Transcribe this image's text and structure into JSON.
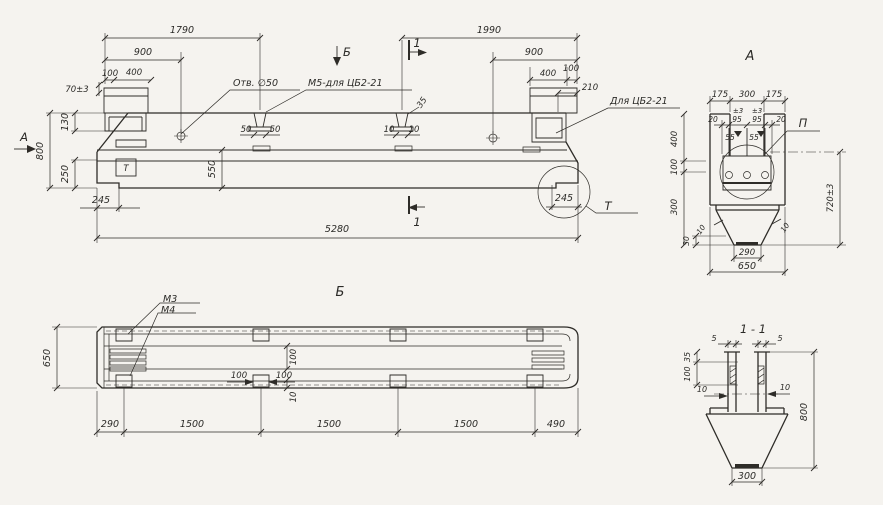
{
  "page": {
    "background": "#f5f3ef",
    "ink": "#2e2c28"
  },
  "main_view": {
    "view_arrow_left": "А",
    "view_arrow_top": "Б",
    "cut_mark_top": "1",
    "cut_mark_bottom": "1",
    "mark_box": "Т",
    "detail_callout": "Т",
    "label_hole": "Отв. ∅50",
    "label_anchor": "М5-для ЦБ2-21",
    "label_right": "Для ЦБ2-21",
    "dims": {
      "len_top_left": "1790",
      "len_top_right": "1990",
      "off_left": "900",
      "off_right": "900",
      "pad_100_left": "100",
      "pad_400_left": "400",
      "pad_400_right": "400",
      "pad_100_right": "100",
      "pad_210": "210",
      "tol_70": "70±3",
      "h_130": "130",
      "h_800": "800",
      "h_250": "250",
      "h_550": "550",
      "len_total": "5280",
      "notch_left": "245",
      "notch_right": "245",
      "stud1_l": "50",
      "stud1_r": "50",
      "stud2_l": "10",
      "stud2_r": "10",
      "stud2_d": "35"
    }
  },
  "view_b": {
    "title": "Б",
    "label_m3": "М3",
    "label_m4": "М4",
    "dims": {
      "width": "650",
      "c290": "290",
      "c1500a": "1500",
      "c1500b": "1500",
      "c1500c": "1500",
      "c490": "490",
      "mid_l": "100",
      "mid_r": "100",
      "mid_v": "100",
      "mid_10": "10"
    }
  },
  "section_a": {
    "title": "А",
    "detail_callout": "П",
    "dims": {
      "t175l": "175",
      "t300": "300",
      "t175r": "175",
      "b20l": "20",
      "b95l": "95",
      "b95r": "95",
      "b20r": "20",
      "tol_l": "±3",
      "tol_r": "±3",
      "w55l": "55",
      "w55r": "55",
      "h400": "400",
      "h100": "100",
      "h300": "300",
      "h30": "30",
      "f10l": "10",
      "f10r": "10",
      "h720": "720±3",
      "b290": "290",
      "b650": "650"
    }
  },
  "section_11": {
    "title": "1 - 1",
    "dims": {
      "t5l": "5",
      "t5r": "5",
      "h35": "35",
      "h100": "100",
      "s10l": "10",
      "s10r": "10",
      "h800": "800",
      "b300": "300"
    }
  }
}
